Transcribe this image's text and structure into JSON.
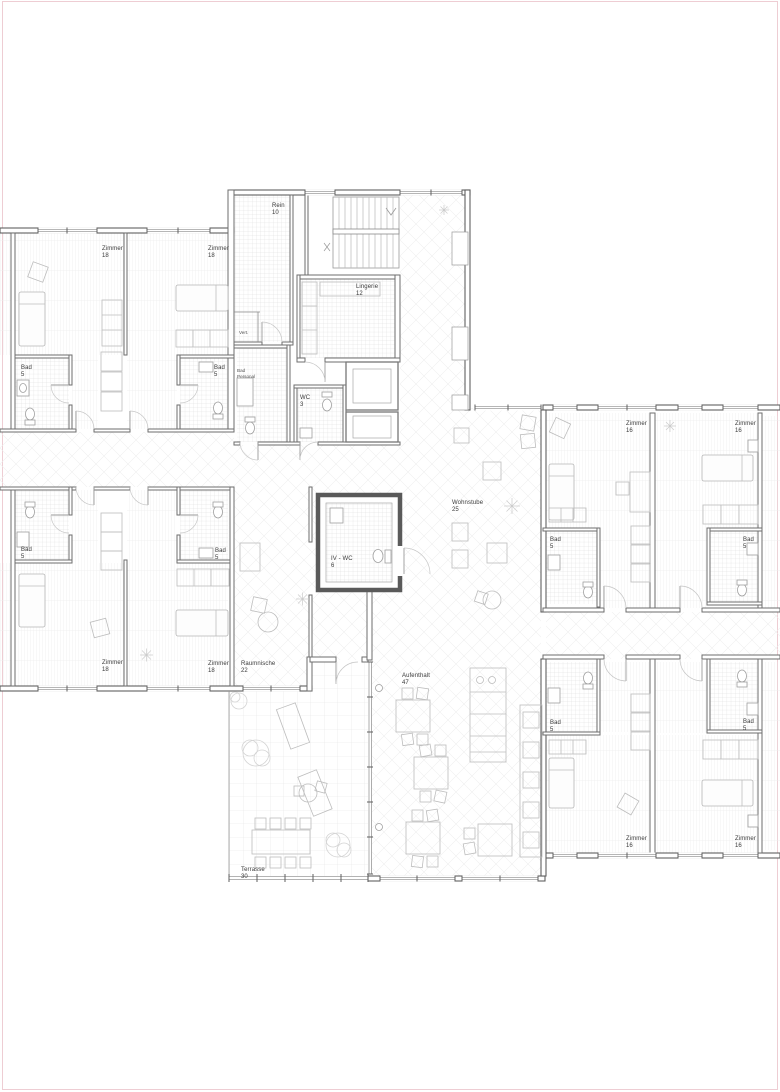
{
  "page": {
    "background": "#ffffff",
    "border_color": "#eecdd3"
  },
  "plan": {
    "type": "architectural-floor-plan",
    "language": "de",
    "colors": {
      "walls": "#606060",
      "text": "#3a3a3a",
      "tile_hatch": "#d9d9d9",
      "plank_hatch": "#e3e3e3",
      "diagonal_hatch": "#efefef",
      "terrace_grid": "#e2e2e2",
      "page_border": "#eecdd3"
    },
    "rooms": {
      "rein": {
        "name": "Rein",
        "area": "10"
      },
      "lingerie": {
        "name": "Lingerie",
        "area": "12"
      },
      "wc": {
        "name": "WC",
        "area": "3"
      },
      "vert": {
        "name": "Vert."
      },
      "bad_personal": {
        "name": "Bad",
        "sub": "Personal"
      },
      "zimmer_tl_1": {
        "name": "Zimmer",
        "area": "18"
      },
      "zimmer_tl_2": {
        "name": "Zimmer",
        "area": "18"
      },
      "bad_tl_1": {
        "name": "Bad",
        "area": "5"
      },
      "bad_tl_2": {
        "name": "Bad",
        "area": "5"
      },
      "bad_bl_1": {
        "name": "Bad",
        "area": "5"
      },
      "bad_bl_2": {
        "name": "Bad",
        "area": "5"
      },
      "zimmer_bl_1": {
        "name": "Zimmer",
        "area": "18"
      },
      "zimmer_bl_2": {
        "name": "Zimmer",
        "area": "18"
      },
      "raumnische": {
        "name": "Raumnische",
        "area": "22"
      },
      "wohnstube": {
        "name": "Wohnstube",
        "area": "25"
      },
      "iv_wc": {
        "name": "IV - WC",
        "area": "6"
      },
      "aufenthalt": {
        "name": "Aufenthalt",
        "area": "47"
      },
      "terrasse": {
        "name": "Terrasse",
        "area": "30"
      },
      "zimmer_tr_1": {
        "name": "Zimmer",
        "area": "16"
      },
      "zimmer_tr_2": {
        "name": "Zimmer",
        "area": "16"
      },
      "bad_tr_1": {
        "name": "Bad",
        "area": "5"
      },
      "bad_tr_2": {
        "name": "Bad",
        "area": "5"
      },
      "bad_br_1": {
        "name": "Bad",
        "area": "5"
      },
      "bad_br_2": {
        "name": "Bad",
        "area": "5"
      },
      "zimmer_br_1": {
        "name": "Zimmer",
        "area": "16"
      },
      "zimmer_br_2": {
        "name": "Zimmer",
        "area": "16"
      }
    }
  }
}
